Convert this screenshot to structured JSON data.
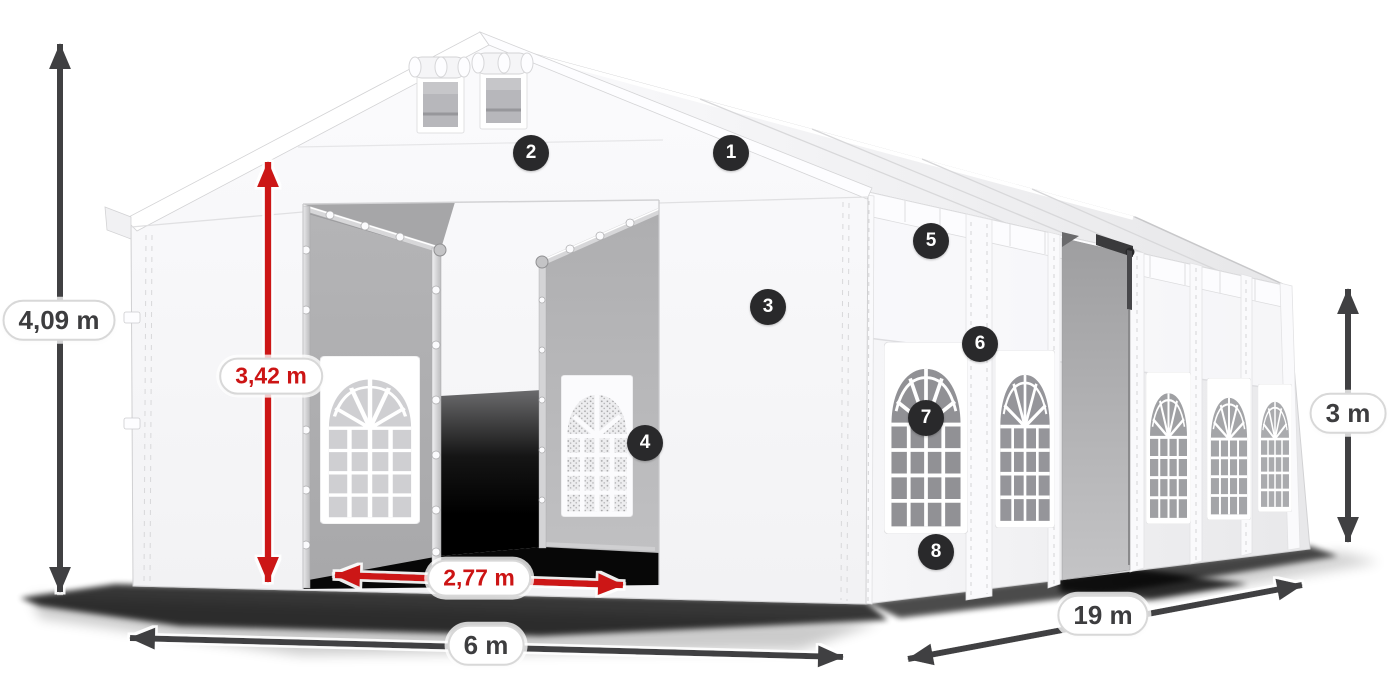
{
  "diagram": {
    "colors": {
      "accent_red": "#cc1414",
      "arrow_dark": "#414143",
      "badge": "#29292b",
      "background": "#ffffff"
    },
    "dimensions": {
      "total_height": "4,09 m",
      "door_height": "3,42 m",
      "door_width": "2,77 m",
      "width": "6 m",
      "length": "19 m",
      "side_height": "3 m"
    },
    "callouts": [
      "1",
      "2",
      "3",
      "4",
      "5",
      "6",
      "7",
      "8"
    ]
  }
}
